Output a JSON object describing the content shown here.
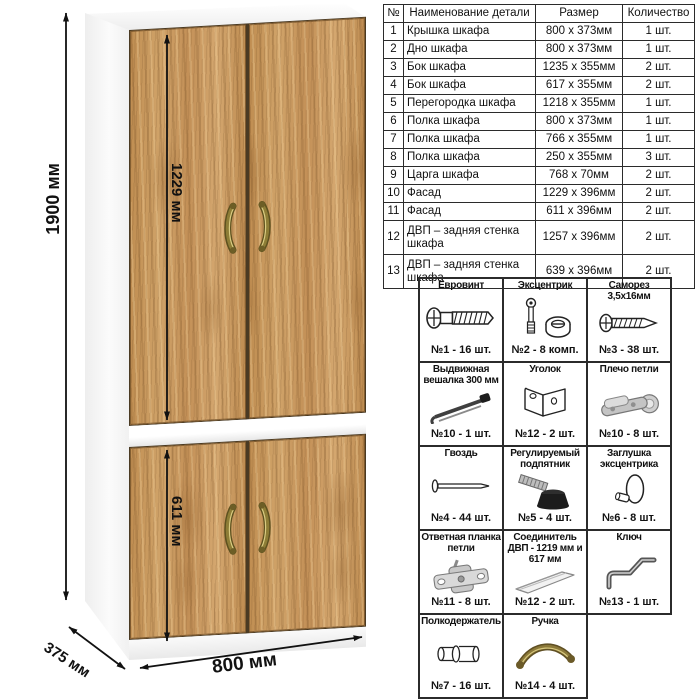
{
  "wardrobe": {
    "dim_height": "1900 мм",
    "dim_upper_door": "1229 мм",
    "dim_lower_door": "611 мм",
    "dim_depth": "375 мм",
    "dim_width": "800 мм",
    "wood_color": "#c89a62",
    "carcass_color": "#fbfbfb",
    "handle_color": "#8d7d36"
  },
  "parts_table": {
    "headers": [
      "№",
      "Наименование детали",
      "Размер",
      "Количество"
    ],
    "rows": [
      [
        "1",
        "Крышка шкафа",
        "800 х 373мм",
        "1 шт."
      ],
      [
        "2",
        "Дно шкафа",
        "800 х 373мм",
        "1 шт."
      ],
      [
        "3",
        "Бок шкафа",
        "1235 х 355мм",
        "2 шт."
      ],
      [
        "4",
        "Бок шкафа",
        "617 х 355мм",
        "2 шт."
      ],
      [
        "5",
        "Перегородка шкафа",
        "1218 х 355мм",
        "1 шт."
      ],
      [
        "6",
        "Полка шкафа",
        "800 х 373мм",
        "1 шт."
      ],
      [
        "7",
        "Полка шкафа",
        "766 х 355мм",
        "1 шт."
      ],
      [
        "8",
        "Полка шкафа",
        "250 х 355мм",
        "3 шт."
      ],
      [
        "9",
        "Царга шкафа",
        "768 х 70мм",
        "2 шт."
      ],
      [
        "10",
        "Фасад",
        "1229 х 396мм",
        "2 шт."
      ],
      [
        "11",
        "Фасад",
        "611 х 396мм",
        "2 шт."
      ],
      [
        "12",
        "ДВП – задняя стенка шкафа",
        "1257 х 396мм",
        "2 шт."
      ],
      [
        "13",
        "ДВП – задняя стенка шкафа",
        "639 х 396мм",
        "2 шт."
      ]
    ]
  },
  "hardware": {
    "items": [
      {
        "name": "Евровинт",
        "count": "№1 - 16 шт."
      },
      {
        "name": "Эксцентрик",
        "count": "№2 - 8 комп."
      },
      {
        "name": "Саморез 3,5х16мм",
        "count": "№3 - 38 шт."
      },
      {
        "name": "Выдвижная вешалка 300 мм",
        "count": "№10 - 1 шт."
      },
      {
        "name": "Уголок",
        "count": "№12 - 2 шт."
      },
      {
        "name": "Плечо петли",
        "count": "№10 - 8 шт."
      },
      {
        "name": "Гвоздь",
        "count": "№4 - 44 шт."
      },
      {
        "name": "Регулируемый подпятник",
        "count": "№5 - 4 шт."
      },
      {
        "name": "Заглушка эксцентрика",
        "count": "№6 - 8 шт."
      },
      {
        "name": "Ответная планка петли",
        "count": "№11 - 8 шт."
      },
      {
        "name": "Соединитель ДВП - 1219 мм и 617 мм",
        "count": "№12 - 2 шт."
      },
      {
        "name": "Ключ",
        "count": "№13 - 1 шт."
      },
      {
        "name": "Полкодержатель",
        "count": "№7 - 16 шт."
      },
      {
        "name": "Ручка",
        "count": "№14 - 4 шт."
      }
    ]
  }
}
